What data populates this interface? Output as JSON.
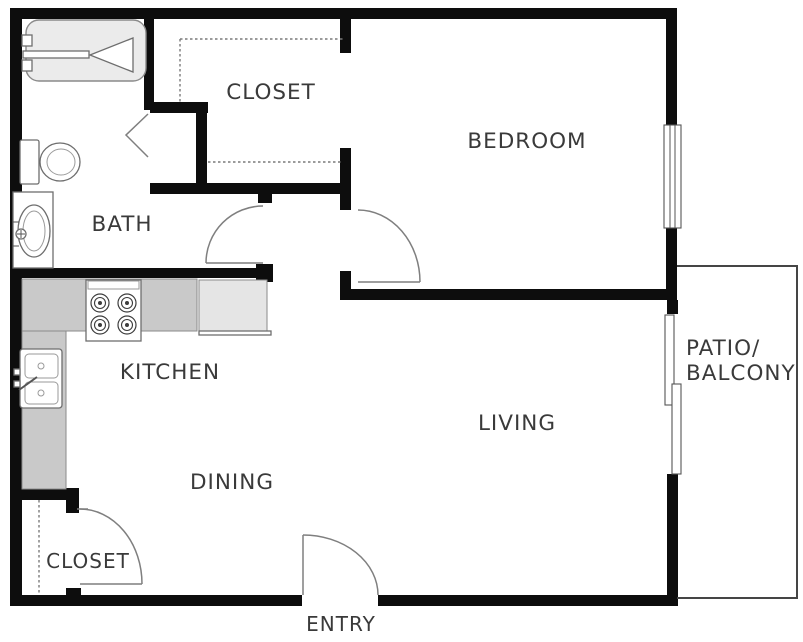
{
  "plan": {
    "type": "apartment-floor-plan",
    "rooms": {
      "bath": {
        "label": "BATH"
      },
      "closet_top": {
        "label": "CLOSET"
      },
      "bedroom": {
        "label": "BEDROOM"
      },
      "kitchen": {
        "label": "KITCHEN"
      },
      "living": {
        "label": "LIVING"
      },
      "dining": {
        "label": "DINING"
      },
      "closet_bottom": {
        "label": "CLOSET"
      },
      "entry": {
        "label": "ENTRY"
      },
      "patio": {
        "label_line1": "PATIO/",
        "label_line2": "BALCONY"
      }
    },
    "fixtures": {
      "bathtub": "bathtub-icon",
      "toilet": "toilet-icon",
      "bath_sink": "bath-sink-icon",
      "stove": "stove-icon",
      "refrigerator": "refrigerator-icon",
      "kitchen_sink": "kitchen-sink-icon",
      "window": "window-icon",
      "sliding_door": "sliding-door-icon",
      "bifold_door": "bifold-door-icon"
    }
  },
  "colors": {
    "wall": "#0d0d0d",
    "thin_wall": "#454545",
    "counter": "#c9c9c9",
    "counter_border": "#8a8a8a",
    "appliance": "#e5e5e5",
    "fixture_border": "#6e6e6e",
    "door_arc": "#7f7f7f",
    "dashed": "#7a7a7a",
    "text": "#3a3a3a",
    "background": "#ffffff"
  }
}
